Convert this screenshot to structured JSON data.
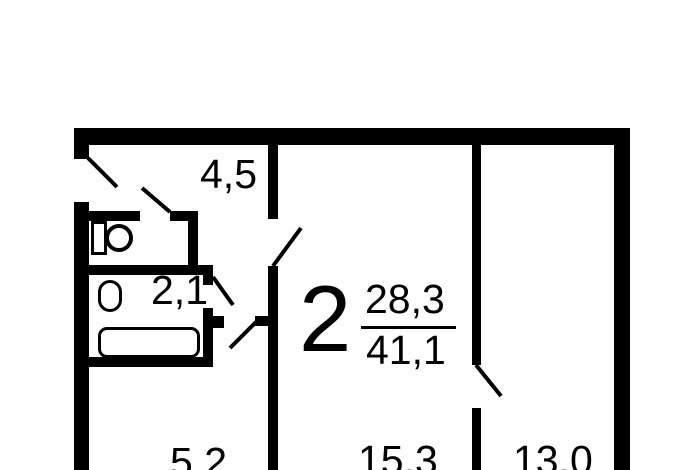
{
  "meta": {
    "type": "apartment-floor-plan",
    "apartment_kind": "2-room flat plan"
  },
  "colors": {
    "background": "#ffffff",
    "ink": "#000000"
  },
  "summary": {
    "rooms_count": "2",
    "living_area": "28,3",
    "total_area": "41,1"
  },
  "rooms": {
    "hallway": {
      "area": "4,5"
    },
    "bathroom": {
      "area": "2,1"
    },
    "kitchen": {
      "area": "5,2"
    },
    "room1": {
      "area": "15,3"
    },
    "room2": {
      "area": "13,0"
    }
  }
}
